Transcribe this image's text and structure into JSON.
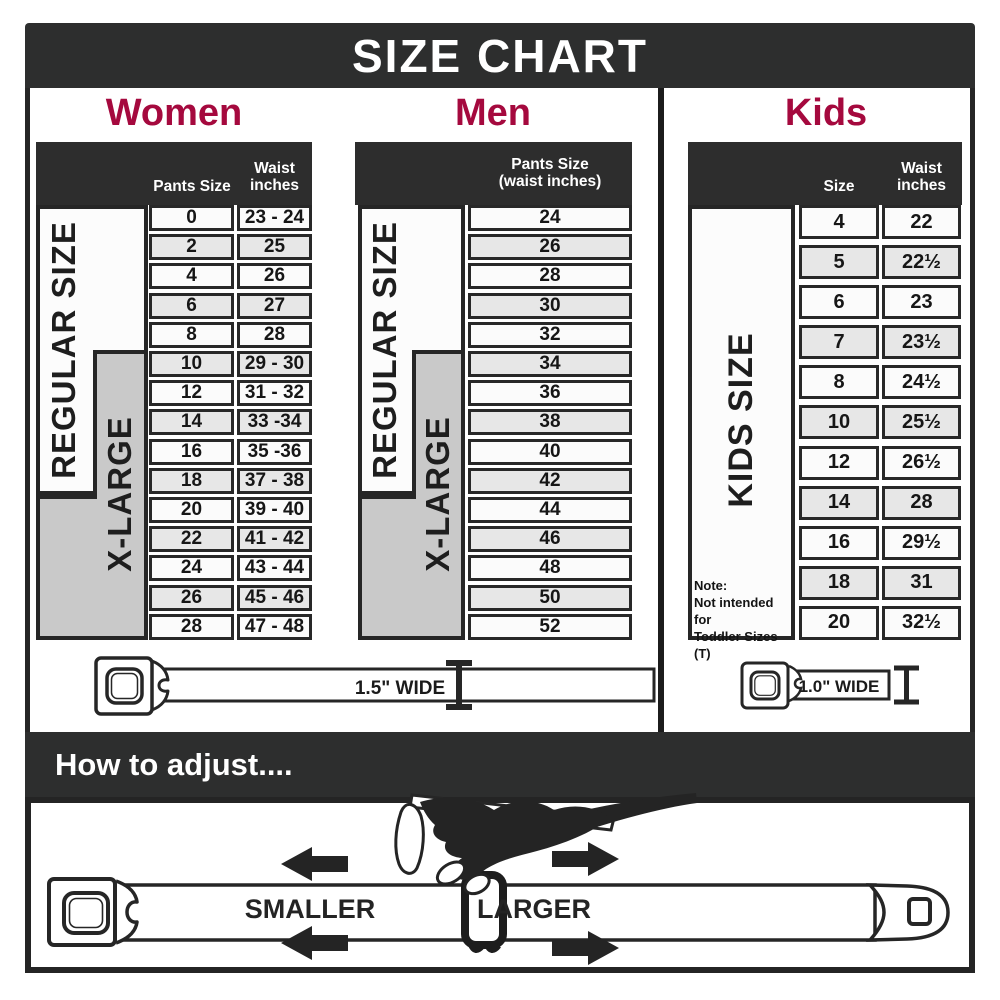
{
  "title": "SIZE CHART",
  "colors": {
    "accent_red": "#A5093E",
    "bar_dark": "#2D2E2E",
    "border_dark": "#262626",
    "row_light": "#FBFBFB",
    "row_shaded": "#E7E7E7",
    "xlarge_gray": "#C9C9C9"
  },
  "women": {
    "heading": "Women",
    "columns": {
      "pants": "Pants Size",
      "waist_line1": "Waist",
      "waist_line2": "inches"
    },
    "regular_label": "REGULAR SIZE",
    "xlarge_label": "X-LARGE",
    "rows": [
      {
        "size": "0",
        "waist": "23 - 24"
      },
      {
        "size": "2",
        "waist": "25"
      },
      {
        "size": "4",
        "waist": "26"
      },
      {
        "size": "6",
        "waist": "27"
      },
      {
        "size": "8",
        "waist": "28"
      },
      {
        "size": "10",
        "waist": "29 - 30"
      },
      {
        "size": "12",
        "waist": "31 - 32"
      },
      {
        "size": "14",
        "waist": "33 -34"
      },
      {
        "size": "16",
        "waist": "35 -36"
      },
      {
        "size": "18",
        "waist": "37 - 38"
      },
      {
        "size": "20",
        "waist": "39 - 40"
      },
      {
        "size": "22",
        "waist": "41 - 42"
      },
      {
        "size": "24",
        "waist": "43 - 44"
      },
      {
        "size": "26",
        "waist": "45 - 46"
      },
      {
        "size": "28",
        "waist": "47 - 48"
      }
    ],
    "belt_width_label": "1.5\" WIDE"
  },
  "men": {
    "heading": "Men",
    "column_header_line1": "Pants Size",
    "column_header_line2": "(waist inches)",
    "regular_label": "REGULAR SIZE",
    "xlarge_label": "X-LARGE",
    "rows": [
      "24",
      "26",
      "28",
      "30",
      "32",
      "34",
      "36",
      "38",
      "40",
      "42",
      "44",
      "46",
      "48",
      "50",
      "52"
    ]
  },
  "kids": {
    "heading": "Kids",
    "columns": {
      "size": "Size",
      "waist_line1": "Waist",
      "waist_line2": "inches"
    },
    "side_label": "KIDS SIZE",
    "note_line1": "Note:",
    "note_line2": "Not intended for",
    "note_line3": "Toddler Sizes (T)",
    "rows": [
      {
        "size": "4",
        "waist": "22"
      },
      {
        "size": "5",
        "waist": "22½"
      },
      {
        "size": "6",
        "waist": "23"
      },
      {
        "size": "7",
        "waist": "23½"
      },
      {
        "size": "8",
        "waist": "24½"
      },
      {
        "size": "10",
        "waist": "25½"
      },
      {
        "size": "12",
        "waist": "26½"
      },
      {
        "size": "14",
        "waist": "28"
      },
      {
        "size": "16",
        "waist": "29½"
      },
      {
        "size": "18",
        "waist": "31"
      },
      {
        "size": "20",
        "waist": "32½"
      }
    ],
    "belt_width_label": "1.0\" WIDE"
  },
  "how_to_adjust": {
    "heading": "How to adjust....",
    "smaller_label": "SMALLER",
    "larger_label": "LARGER"
  }
}
